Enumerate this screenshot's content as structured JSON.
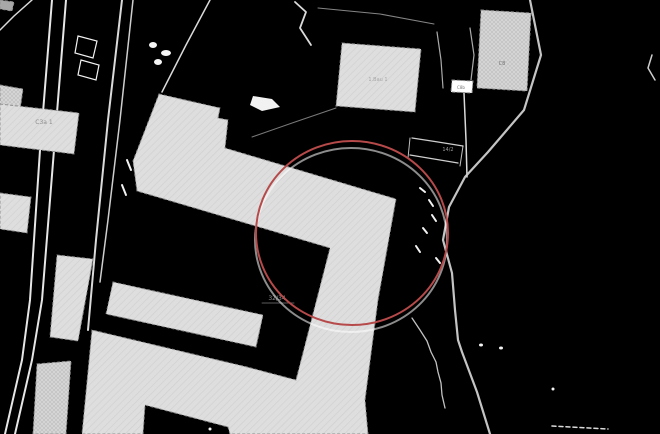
{
  "map": {
    "background_color": "#000000",
    "building_fill": "#dedede",
    "building_outline": "#8f8f8f",
    "boundary_color": "#f2f2f2",
    "annotation": {
      "type": "highlight-circle",
      "color": "#b64949",
      "shadow_color": "rgba(255,255,255,0.55)",
      "center_x": 352,
      "center_y": 233,
      "radius_x": 96,
      "radius_y": 92,
      "stroke_width": 2
    },
    "boundary_lines": [
      {
        "name": "road-line-1",
        "points": "52,0 40,150 30,300 22,360 5,434",
        "width": 2,
        "opacity": 0.95
      },
      {
        "name": "road-line-2",
        "points": "66,0 54,150 42,300 32,360 15,434",
        "width": 2,
        "opacity": 0.95
      },
      {
        "name": "road-line-3",
        "points": "122,0 108,120 96,240 88,330",
        "width": 2,
        "opacity": 0.9
      },
      {
        "name": "road-line-4",
        "points": "133,0 120,120 108,220 100,282",
        "width": 1.5,
        "opacity": 0.85
      },
      {
        "name": "corner-line",
        "points": "32,0 14,16 0,30",
        "width": 1.5,
        "opacity": 0.9
      },
      {
        "name": "tower-parcel-line",
        "points": "210,0 186,45 162,92",
        "width": 1.5,
        "opacity": 0.9
      },
      {
        "name": "square-parcel-line-top",
        "points": "318,8 380,14 434,24",
        "width": 1,
        "opacity": 0.55
      },
      {
        "name": "square-parcel-line-bottom",
        "points": "336,108 295,122 252,137",
        "width": 1,
        "opacity": 0.5
      },
      {
        "name": "v-line-0",
        "points": "437,32 441,60 443,88",
        "width": 1.2,
        "opacity": 0.7
      },
      {
        "name": "v-line-1",
        "points": "464,93 466,140 467,177",
        "width": 1.5,
        "opacity": 0.9
      },
      {
        "name": "gap-line",
        "points": "470,28 474,55 471,80",
        "width": 1.2,
        "opacity": 0.7
      },
      {
        "name": "main-curve",
        "points": "530,0 541,55 524,110 488,152 465,177 449,207 443,240 452,273 455,310 458,340 462,352 477,392 490,434",
        "width": 2.2,
        "color": "#cfcfcf",
        "opacity": 0.95
      },
      {
        "name": "wiggle-line",
        "points": "412,318 420,330 427,341 431,352 436,362 438,372 441,383 442,395 445,408",
        "width": 1.3,
        "opacity": 0.8
      },
      {
        "name": "parcel-line-a",
        "points": "412,138 438,142 463,146",
        "width": 1.3,
        "opacity": 0.85
      },
      {
        "name": "parcel-line-b",
        "points": "410,155 434,159 458,163",
        "width": 1.3,
        "opacity": 0.85
      },
      {
        "name": "parcel-line-c",
        "points": "410,138 408,158",
        "width": 1,
        "opacity": 0.8
      },
      {
        "name": "parcel-line-d",
        "points": "463,146 460,166",
        "width": 1,
        "opacity": 0.8
      },
      {
        "name": "dashed-fragment",
        "points": "552,426 608,429",
        "width": 1.5,
        "dash": "4 3",
        "opacity": 0.9
      },
      {
        "name": "squiggle-top",
        "points": "295,2 306,12 300,28 311,45",
        "width": 1.8,
        "opacity": 0.9
      },
      {
        "name": "right-edge-mark",
        "points": "652,55 648,68 655,80",
        "width": 1.5,
        "opacity": 0.85
      },
      {
        "name": "label-underline",
        "points": "262,303 294,303",
        "width": 0.8,
        "color": "#8a8a8a",
        "opacity": 0.9
      }
    ],
    "buildings": [
      {
        "name": "building-corner-piece",
        "points": "0,0 14,2 12,11 0,9",
        "pattern": "solid",
        "fill": "#a8a8a8"
      },
      {
        "name": "building-hatched-top-left",
        "points": "0,85 23,89 20,110 0,106",
        "pattern": "crosshatch"
      },
      {
        "name": "building-c3a1",
        "points": "0,104 79,113 74,154 0,145",
        "pattern": "hatch"
      },
      {
        "name": "building-small-left",
        "points": "0,193 31,197 27,233 0,229",
        "pattern": "hatch"
      },
      {
        "name": "building-strip-left",
        "points": "57,255 93,259 78,341 50,337",
        "pattern": "hatch"
      },
      {
        "name": "building-hatched-strip-bottom",
        "points": "37,364 71,361 66,434 33,434",
        "pattern": "crosshatch"
      },
      {
        "name": "building-lower-bar",
        "points": "113,282 263,315 256,347 106,314",
        "pattern": "hatch"
      },
      {
        "name": "building-main-complex",
        "points": "159,94 220,108 218,118 228,120 225,148 396,199 378,300 365,400 368,434 230,434 228,427 145,405 143,434 82,434 92,330 247,367 296,380 330,248 137,191 133,161",
        "pattern": "hatch"
      },
      {
        "name": "building-square-top",
        "points": "342,43 421,49 415,112 336,106",
        "pattern": "hatch"
      },
      {
        "name": "building-top-right",
        "points": "481,10 531,13 527,91 477,88",
        "pattern": "crosshatch"
      },
      {
        "name": "building-white-box",
        "points": "452,80 473,81 472,93 451,92",
        "pattern": "solid",
        "fill": "#ffffff"
      }
    ],
    "marks": [
      {
        "name": "white-outline-1",
        "type": "polygon",
        "points": "78,36 97,41 93,58 75,53"
      },
      {
        "name": "white-outline-2",
        "type": "polygon",
        "points": "81,60 99,65 96,80 78,75"
      },
      {
        "name": "white-patch-1",
        "type": "ellipse",
        "cx": 153,
        "cy": 45,
        "rx": 4,
        "ry": 3
      },
      {
        "name": "white-patch-2",
        "type": "ellipse",
        "cx": 166,
        "cy": 53,
        "rx": 5,
        "ry": 3
      },
      {
        "name": "white-patch-3",
        "type": "ellipse",
        "cx": 158,
        "cy": 62,
        "rx": 4,
        "ry": 3
      },
      {
        "name": "white-blob",
        "type": "blob",
        "points": "253,96 272,99 280,107 262,111 250,105"
      },
      {
        "name": "dash-1",
        "type": "seg",
        "points": "420,188 425,192"
      },
      {
        "name": "dash-2",
        "type": "seg",
        "points": "429,200 433,206"
      },
      {
        "name": "dash-3",
        "type": "seg",
        "points": "432,215 436,221"
      },
      {
        "name": "dash-4",
        "type": "seg",
        "points": "423,228 427,233"
      },
      {
        "name": "dash-5",
        "type": "seg",
        "points": "416,246 420,252"
      },
      {
        "name": "dash-6",
        "type": "seg",
        "points": "436,258 440,263"
      },
      {
        "name": "dash-7",
        "type": "seg",
        "points": "127,160 131,170"
      },
      {
        "name": "dash-8",
        "type": "seg",
        "points": "122,185 126,195"
      },
      {
        "name": "dot-1",
        "type": "ellipse",
        "cx": 481,
        "cy": 345,
        "rx": 2,
        "ry": 1.5
      },
      {
        "name": "dot-2",
        "type": "ellipse",
        "cx": 501,
        "cy": 348,
        "rx": 2,
        "ry": 1.5
      },
      {
        "name": "dot-3",
        "type": "ellipse",
        "cx": 553,
        "cy": 389,
        "rx": 1.5,
        "ry": 1.5
      },
      {
        "name": "dot-4",
        "type": "ellipse",
        "cx": 210,
        "cy": 429,
        "rx": 1.5,
        "ry": 1.5
      }
    ],
    "labels": [
      {
        "name": "label-c3a1",
        "text": "C3a 1",
        "x": 44,
        "y": 124,
        "size": 6,
        "color": "#8c8c8c"
      },
      {
        "name": "label-square-building",
        "text": "1.Bau 1",
        "x": 378,
        "y": 81,
        "size": 5,
        "color": "#a6a6a6"
      },
      {
        "name": "label-c8",
        "text": "C8",
        "x": 502,
        "y": 65,
        "size": 5,
        "color": "#6f6f6f"
      },
      {
        "name": "label-c8b",
        "text": "C8b",
        "x": 461,
        "y": 89,
        "size": 4,
        "color": "#777777"
      },
      {
        "name": "label-parcel-14-2",
        "text": "14/2",
        "x": 448,
        "y": 151,
        "size": 5,
        "color": "#9a9a9a"
      },
      {
        "name": "label-parcel-32-34",
        "text": "32/34",
        "x": 277,
        "y": 300,
        "size": 6,
        "color": "#8f8f8f"
      }
    ]
  }
}
